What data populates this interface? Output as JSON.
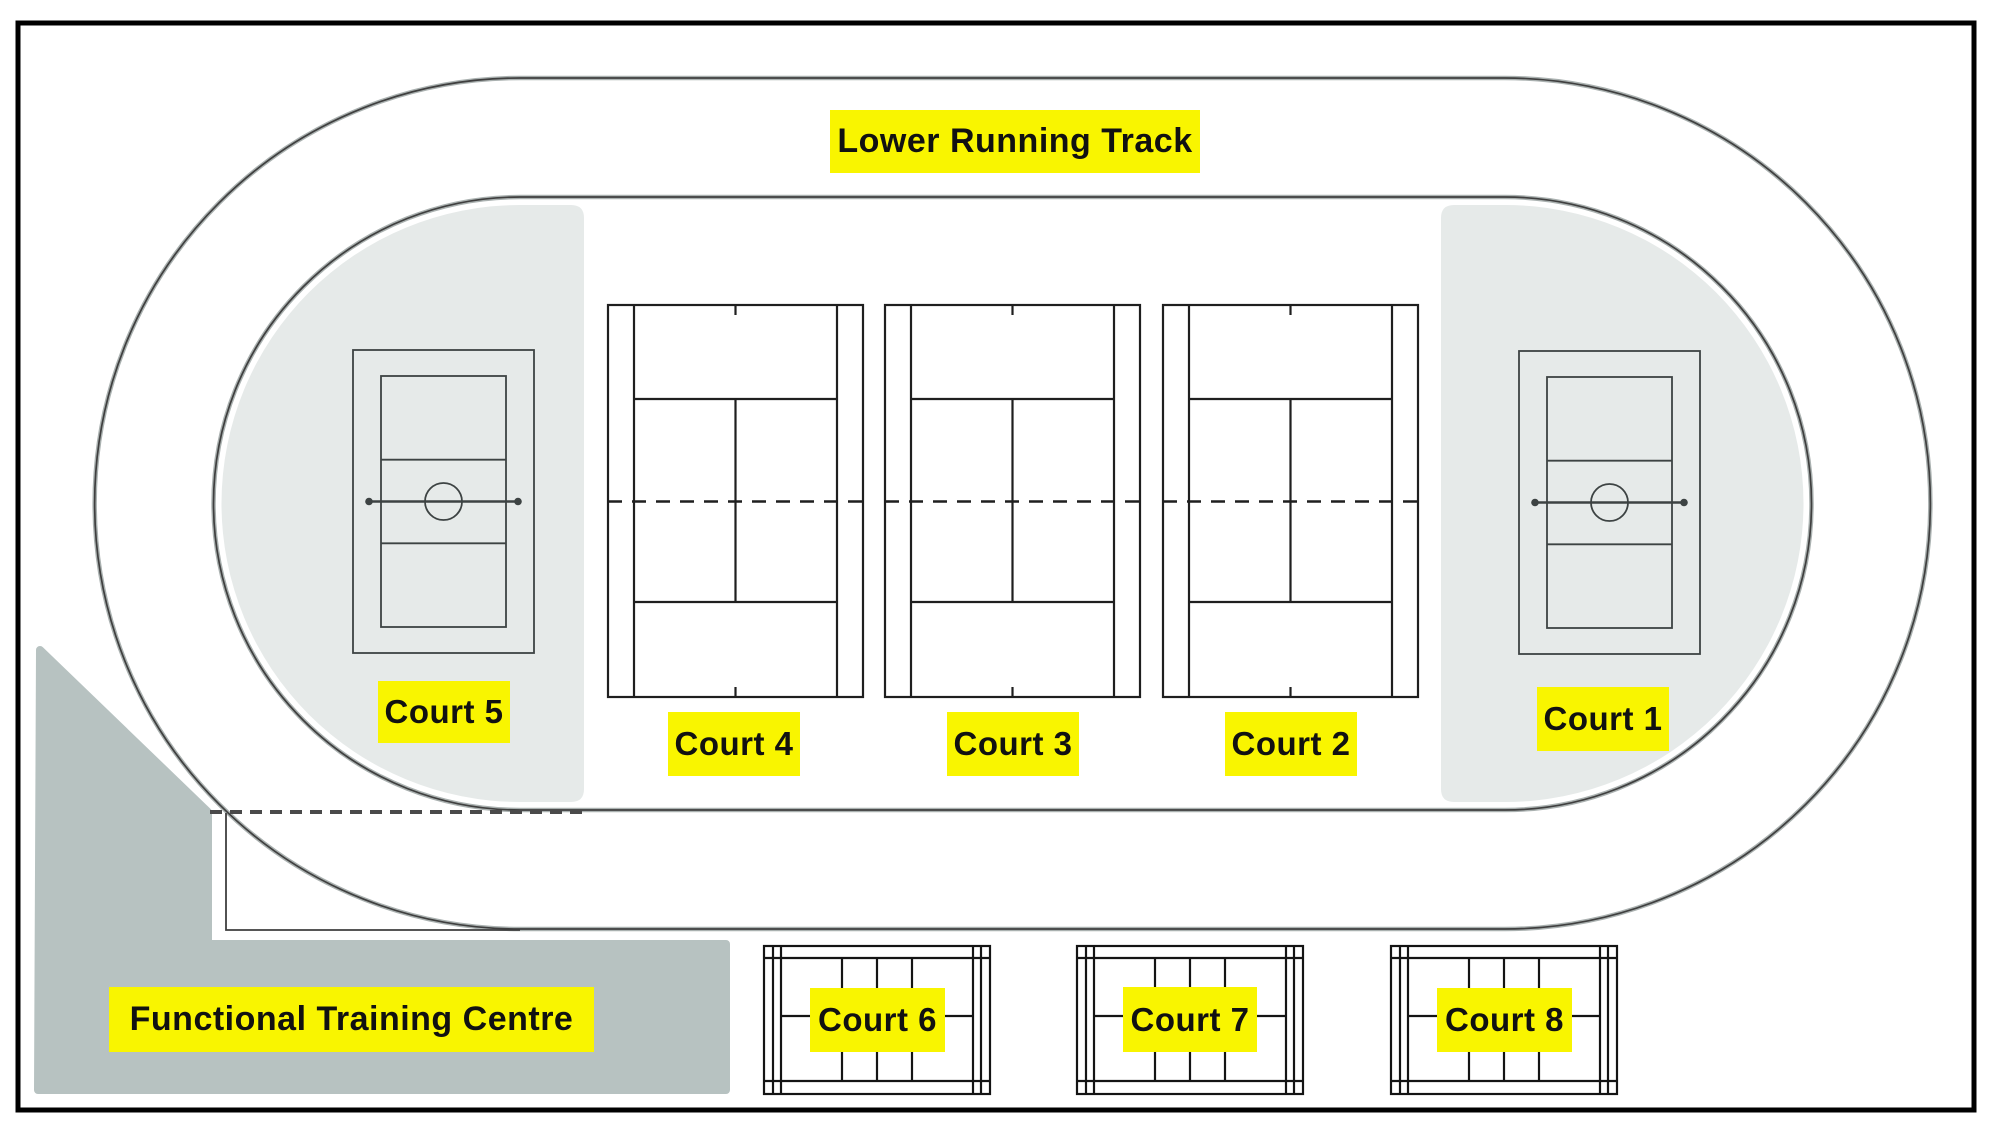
{
  "colors": {
    "label_background": "#F9F500",
    "label_text": "#111111",
    "infield_zone_fill": "#E6EAE9",
    "functional_training_centre_fill": "#B7C2C1",
    "track_line": "#3F3F3F",
    "background": "#FFFFFF"
  },
  "track": {
    "label": "Lower Running Track"
  },
  "functional_training_centre": {
    "label": "Functional Training Centre"
  },
  "courts": {
    "court1": {
      "label": "Court 1",
      "type": "netball-volleyball court"
    },
    "court2": {
      "label": "Court 2",
      "type": "tennis court"
    },
    "court3": {
      "label": "Court 3",
      "type": "tennis court"
    },
    "court4": {
      "label": "Court 4",
      "type": "tennis court"
    },
    "court5": {
      "label": "Court 5",
      "type": "netball-volleyball court"
    },
    "court6": {
      "label": "Court 6",
      "type": "badminton court"
    },
    "court7": {
      "label": "Court 7",
      "type": "badminton court"
    },
    "court8": {
      "label": "Court 8",
      "type": "badminton court"
    }
  }
}
